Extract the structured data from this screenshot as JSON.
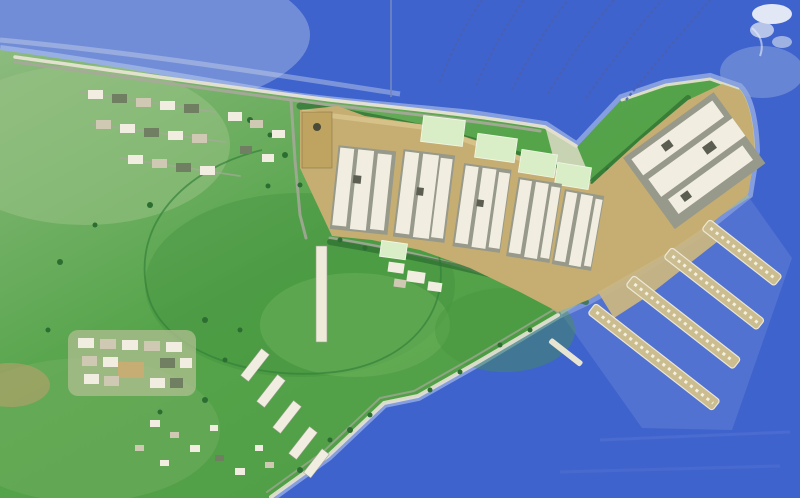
{
  "meta": {
    "description": "Illustrated aerial master-plan rendering of a coastal waterfront development with a boomerang-shaped building complex, green open fields, small villages and a marina with finger piers",
    "visible_text": "none",
    "width_px": 800,
    "height_px": 498
  },
  "palette": {
    "water_light": "#8ea6db",
    "water_mid": "#5e7cd2",
    "water_deep": "#3f63cd",
    "water_shallow": "#b3c6ec",
    "beach": "#e7e3d2",
    "road": "#a8a89b",
    "land_light": "#8cbb7e",
    "land_mid": "#55a44a",
    "land_dark": "#3e8f3b",
    "tree": "#2c6e31",
    "band_tan": "#c6ae72",
    "band_tan_dark": "#bfa360",
    "plot_green": "#d9eec7",
    "building_white": "#f1eee1",
    "building_shadow": "#97998b",
    "building_dark": "#5c5e52",
    "pier_tan": "#cbbd8f",
    "pier_edge": "#ece7d5",
    "seawall": "#9db4a9",
    "arc_blue": "#4a5eae",
    "leader": "#7388c2",
    "wake_white": "#f3f5f8"
  },
  "features": {
    "sea": {
      "label": "sea surrounding site on north, east and south-east"
    },
    "landmass": {
      "label": "green coastal land occupying left two-thirds"
    },
    "development_band": {
      "label": "waterfront building complex (boomerang shaped, tan ground with white blocks)",
      "building_clusters": 6
    },
    "green_plots": {
      "label": "pale green plots along top of complex",
      "count": 6
    },
    "marina": {
      "label": "marina with finger piers extending south-east",
      "pier_count": 4,
      "small_dock_count": 1
    },
    "route_arcs": {
      "label": "dashed blue arcs sweeping over the water to top edge",
      "count": 6
    },
    "leader_line": {
      "label": "thin vertical leader line from top edge to shore",
      "count": 1
    },
    "villages": {
      "label": "small low-rise clusters on the green land",
      "count": 3
    },
    "central_field": {
      "label": "large open green field with loop path"
    },
    "boat_wake": {
      "label": "small white boat/wake at top-right corner"
    }
  }
}
